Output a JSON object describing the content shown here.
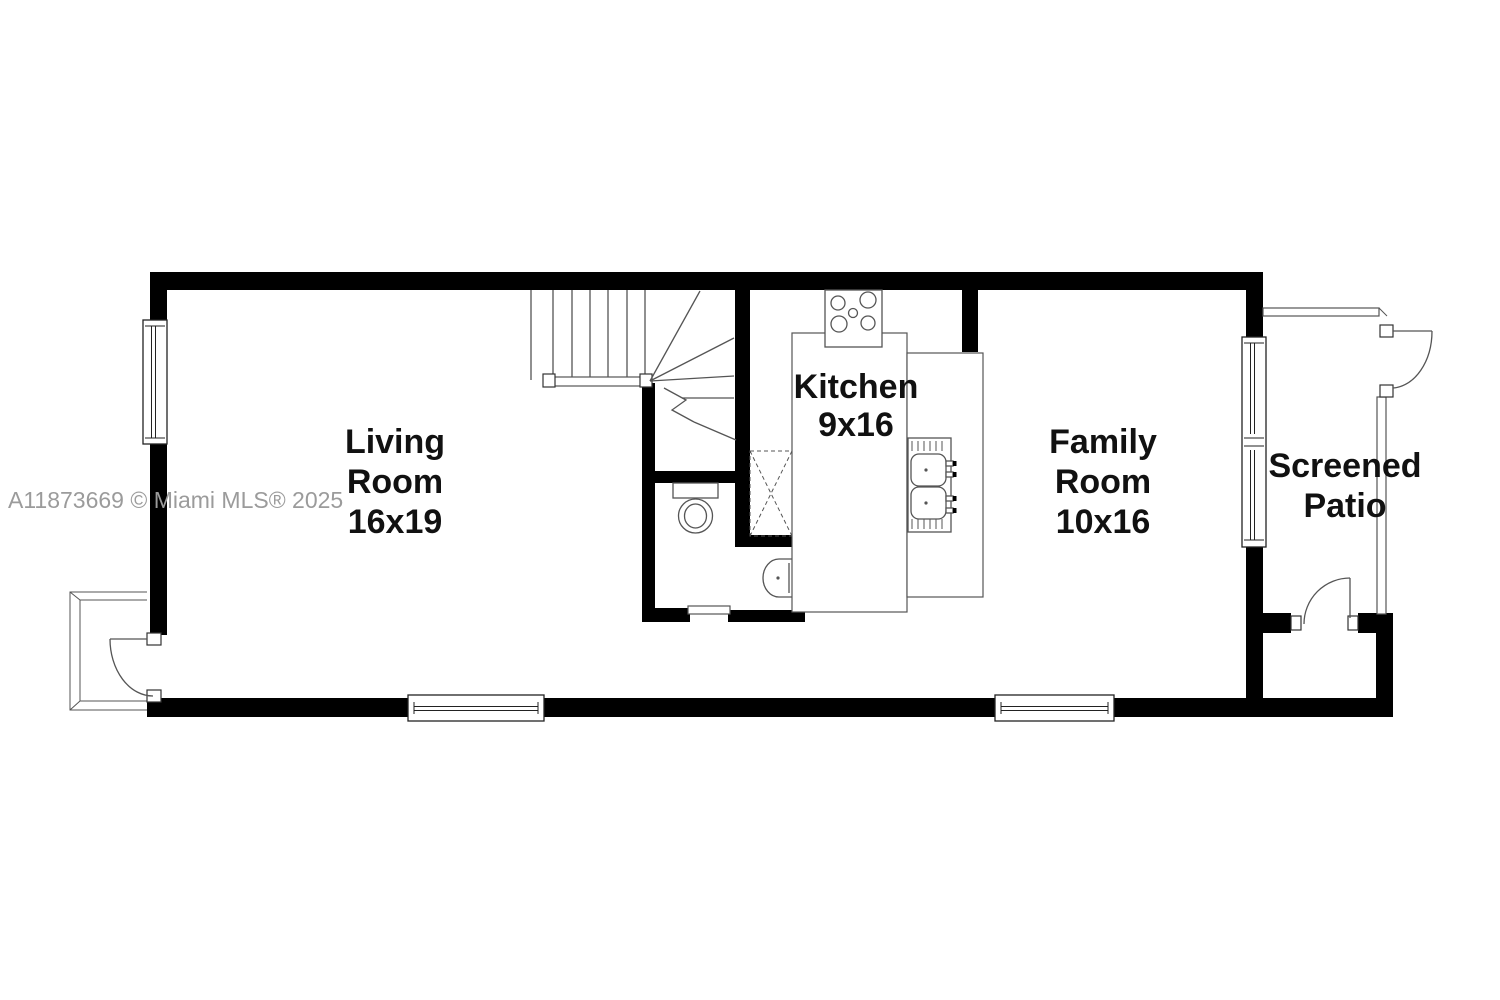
{
  "watermark": "A11873669 © Miami MLS® 2025",
  "colors": {
    "background": "#ffffff",
    "wall": "#000000",
    "line": "#555555",
    "text": "#111111",
    "watermark": "#9b9b9b"
  },
  "rooms": {
    "living": {
      "name": "Living Room",
      "size": "16x19",
      "lines": [
        "Living",
        "Room",
        "16x19"
      ]
    },
    "kitchen": {
      "name": "Kitchen",
      "size": "9x16",
      "lines": [
        "Kitchen",
        "9x16"
      ]
    },
    "family": {
      "name": "Family Room",
      "size": "10x16",
      "lines": [
        "Family",
        "Room",
        "10x16"
      ]
    },
    "patio": {
      "name": "Screened Patio",
      "lines": [
        "Screened",
        "Patio"
      ]
    }
  }
}
